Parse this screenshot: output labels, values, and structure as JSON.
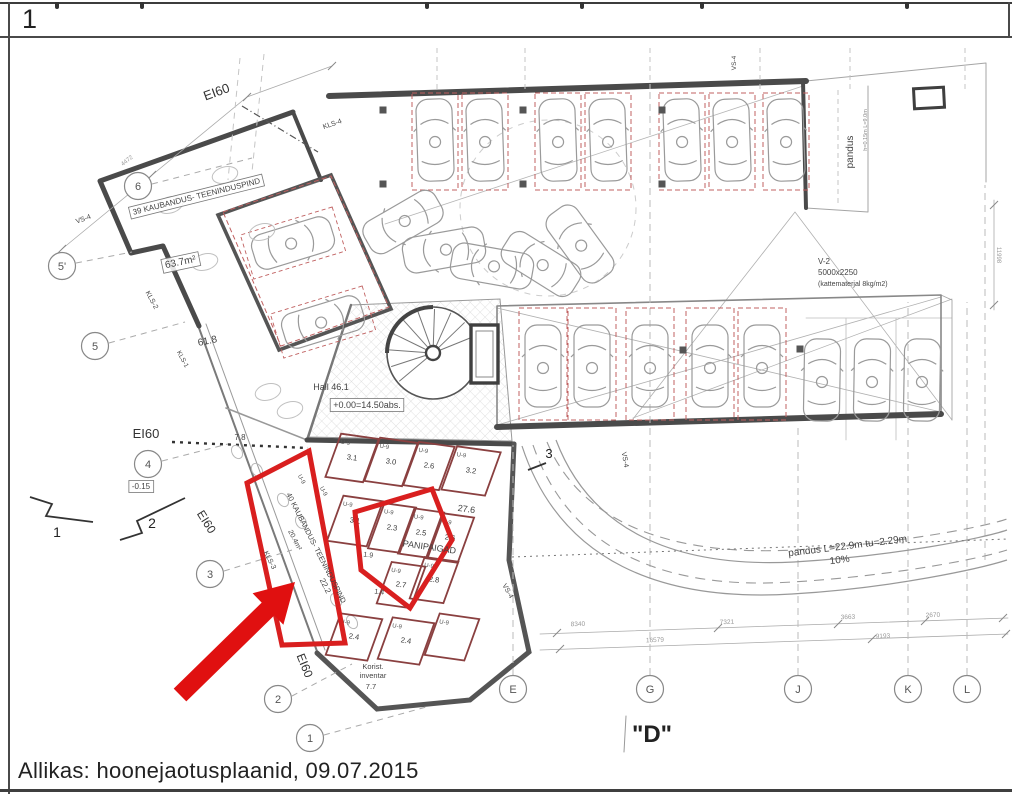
{
  "page": {
    "sheet_number": "1",
    "caption": "Allikas: hoonejaotusplaanid, 09.07.2015",
    "detail_label": "\"D\""
  },
  "colors": {
    "highlight_red": "#d91f1f",
    "arrow_red": "#e01010",
    "wall_dark": "#4a4a4a",
    "drawing_gray": "#9a9a9a",
    "parking_stall_red": "#c06060",
    "storage_wall_red": "#8a4040",
    "text_dark": "#333333"
  },
  "plan": {
    "grid_left": [
      {
        "label": "6",
        "x": 138,
        "y": 186
      },
      {
        "label": "5'",
        "x": 62,
        "y": 266
      },
      {
        "label": "5",
        "x": 95,
        "y": 346
      },
      {
        "label": "4",
        "x": 148,
        "y": 464
      },
      {
        "label": "3",
        "x": 210,
        "y": 574
      },
      {
        "label": "2",
        "x": 278,
        "y": 699
      },
      {
        "label": "1",
        "x": 310,
        "y": 738
      }
    ],
    "grid_bottom": [
      {
        "label": "E",
        "x": 513,
        "y": 689
      },
      {
        "label": "G",
        "x": 650,
        "y": 689
      },
      {
        "label": "J",
        "x": 798,
        "y": 689
      },
      {
        "label": "K",
        "x": 908,
        "y": 689
      },
      {
        "label": "L",
        "x": 967,
        "y": 689
      }
    ],
    "labels": [
      {
        "t": "EI60",
        "x": 218,
        "y": 96,
        "r": -20,
        "s": 13,
        "c": "#333"
      },
      {
        "t": "KLS-4",
        "x": 333,
        "y": 126,
        "r": -19,
        "s": 7
      },
      {
        "t": "VS-4",
        "x": 84,
        "y": 221,
        "r": -20,
        "s": 7
      },
      {
        "t": "4472",
        "x": 128,
        "y": 162,
        "r": -38,
        "s": 6,
        "c": "#999"
      },
      {
        "t": "39 KAUBANDUS- TEENINDUSPIND",
        "x": 197,
        "y": 199,
        "r": -14,
        "s": 8,
        "b": 1
      },
      {
        "t": "63.7m²",
        "x": 181,
        "y": 265,
        "r": -12,
        "s": 10,
        "b": 1
      },
      {
        "t": "KLS-2",
        "x": 150,
        "y": 301,
        "r": 62,
        "s": 7
      },
      {
        "t": "61.8",
        "x": 208,
        "y": 344,
        "r": -12,
        "s": 10
      },
      {
        "t": "KLS-1",
        "x": 181,
        "y": 360,
        "r": 62,
        "s": 6.5
      },
      {
        "t": "Hall   46.1",
        "x": 331,
        "y": 390,
        "r": 0,
        "s": 9
      },
      {
        "t": "+0.00=14.50abs.",
        "x": 367,
        "y": 408,
        "r": 0,
        "s": 9,
        "b": 1
      },
      {
        "t": "7.8",
        "x": 240,
        "y": 440,
        "r": 0,
        "s": 8
      },
      {
        "t": "EI60",
        "x": 146,
        "y": 438,
        "r": 0,
        "s": 13,
        "c": "#333"
      },
      {
        "t": "-0.15",
        "x": 141,
        "y": 489,
        "r": 0,
        "s": 8,
        "b": 1
      },
      {
        "t": "EI60",
        "x": 203,
        "y": 524,
        "r": 58,
        "s": 12,
        "c": "#333"
      },
      {
        "t": "U-9",
        "x": 300,
        "y": 480,
        "r": 62,
        "s": 6
      },
      {
        "t": "U-9",
        "x": 322,
        "y": 492,
        "r": 62,
        "s": 6
      },
      {
        "t": "40 KAUBANDUS- TEENINDUSPIND",
        "x": 314,
        "y": 549,
        "r": 63,
        "s": 7.5
      },
      {
        "t": "20.4m²",
        "x": 293,
        "y": 541,
        "r": 63,
        "s": 7
      },
      {
        "t": "KLS-3",
        "x": 268,
        "y": 561,
        "r": 63,
        "s": 7
      },
      {
        "t": "22.2",
        "x": 323,
        "y": 587,
        "r": 63,
        "s": 8
      },
      {
        "t": "EI60",
        "x": 301,
        "y": 667,
        "r": 68,
        "s": 12,
        "c": "#333"
      },
      {
        "t": "PANIPAIGAD",
        "x": 429,
        "y": 550,
        "r": 8,
        "s": 9
      },
      {
        "t": "27.6",
        "x": 466,
        "y": 512,
        "r": 8,
        "s": 9
      },
      {
        "t": "1.9",
        "x": 368,
        "y": 557,
        "r": 8,
        "s": 7
      },
      {
        "t": "1.4",
        "x": 379,
        "y": 594,
        "r": 8,
        "s": 7
      },
      {
        "t": "Korist.",
        "x": 373,
        "y": 669,
        "r": 0,
        "s": 7.5
      },
      {
        "t": "inventar",
        "x": 373,
        "y": 678,
        "r": 0,
        "s": 7.5
      },
      {
        "t": "7.7",
        "x": 371,
        "y": 689,
        "r": 0,
        "s": 7.5
      },
      {
        "t": "VS-4",
        "x": 506,
        "y": 592,
        "r": 60,
        "s": 7
      },
      {
        "t": "VS-4",
        "x": 623,
        "y": 460,
        "r": 80,
        "s": 7
      },
      {
        "t": "VS-4",
        "x": 736,
        "y": 63,
        "r": -90,
        "s": 6.5
      },
      {
        "t": "V-2",
        "x": 818,
        "y": 264,
        "r": 0,
        "s": 8,
        "a": "start"
      },
      {
        "t": "5000x2250",
        "x": 818,
        "y": 275,
        "r": 0,
        "s": 8,
        "a": "start"
      },
      {
        "t": "(kattematerjal 8kg/m2)",
        "x": 818,
        "y": 286,
        "r": 0,
        "s": 7,
        "a": "start"
      },
      {
        "t": "pandus",
        "x": 853,
        "y": 152,
        "r": -90,
        "s": 10
      },
      {
        "t": "h=0.15m L=9.0m",
        "x": 867,
        "y": 130,
        "r": -90,
        "s": 5.5,
        "c": "#888"
      },
      {
        "t": "pandus L=22.9m tu=2.29m",
        "x": 848,
        "y": 549,
        "r": -7,
        "s": 10
      },
      {
        "t": "10%",
        "x": 840,
        "y": 563,
        "r": -7,
        "s": 10
      },
      {
        "t": "8340",
        "x": 578,
        "y": 626,
        "r": -2,
        "s": 6.5,
        "c": "#999"
      },
      {
        "t": "7321",
        "x": 727,
        "y": 624,
        "r": -2,
        "s": 6.5,
        "c": "#999"
      },
      {
        "t": "3663",
        "x": 848,
        "y": 619,
        "r": -2,
        "s": 6.5,
        "c": "#999"
      },
      {
        "t": "2670",
        "x": 933,
        "y": 617,
        "r": -2,
        "s": 6.5,
        "c": "#999"
      },
      {
        "t": "16579",
        "x": 655,
        "y": 642,
        "r": -2,
        "s": 6.5,
        "c": "#999"
      },
      {
        "t": "9193",
        "x": 883,
        "y": 638,
        "r": -2,
        "s": 6.5,
        "c": "#999"
      },
      {
        "t": "11998",
        "x": 997,
        "y": 255,
        "r": 90,
        "s": 6,
        "c": "#999"
      },
      {
        "t": "1",
        "x": 57,
        "y": 537,
        "r": 0,
        "s": 14,
        "c": "#222"
      },
      {
        "t": "2",
        "x": 152,
        "y": 528,
        "r": 0,
        "s": 14,
        "c": "#222"
      },
      {
        "t": "3",
        "x": 549,
        "y": 458,
        "r": 0,
        "s": 13,
        "c": "#222"
      },
      {
        "t": "\"D\"",
        "x": 652,
        "y": 742,
        "r": 0,
        "s": 24,
        "c": "#222",
        "w": 700
      }
    ],
    "storage_rooms": [
      {
        "n": "3.1",
        "x": 352,
        "y": 458,
        "w": 38,
        "h": 46
      },
      {
        "n": "3.0",
        "x": 391,
        "y": 462,
        "w": 38,
        "h": 46
      },
      {
        "n": "2.6",
        "x": 429,
        "y": 466,
        "w": 36,
        "h": 46
      },
      {
        "n": "3.2",
        "x": 471,
        "y": 471,
        "w": 44,
        "h": 46
      },
      {
        "n": "3.1",
        "x": 355,
        "y": 521,
        "w": 40,
        "h": 48
      },
      {
        "n": "2.3",
        "x": 392,
        "y": 528,
        "w": 32,
        "h": 48
      },
      {
        "n": "2.5",
        "x": 421,
        "y": 533,
        "w": 30,
        "h": 48
      },
      {
        "n": "2.6",
        "x": 450,
        "y": 538,
        "w": 32,
        "h": 48
      },
      {
        "n": "2.7",
        "x": 401,
        "y": 585,
        "w": 34,
        "h": 44
      },
      {
        "n": "2.8",
        "x": 434,
        "y": 580,
        "w": 34,
        "h": 44
      },
      {
        "n": "2.4",
        "x": 354,
        "y": 637,
        "w": 42,
        "h": 44
      },
      {
        "n": "2.4",
        "x": 406,
        "y": 641,
        "w": 42,
        "h": 44
      },
      {
        "n": "",
        "x": 452,
        "y": 637,
        "w": 40,
        "h": 44
      }
    ],
    "storage_door_label": "U-9",
    "parking": {
      "top_row_y": 140,
      "top_row_x": [
        435,
        485,
        558,
        608,
        682,
        732,
        786
      ],
      "middle_row_y": 366,
      "middle_row_x": [
        543,
        592,
        650,
        710,
        762
      ],
      "right_row_y": 380,
      "right_row_x": [
        822,
        872,
        922
      ],
      "garage_tilted": [
        {
          "x": 293,
          "y": 243,
          "r": 73
        },
        {
          "x": 323,
          "y": 322,
          "r": 73
        }
      ],
      "sweep": [
        {
          "x": 403,
          "y": 222,
          "r": -120
        },
        {
          "x": 444,
          "y": 250,
          "r": -100
        },
        {
          "x": 492,
          "y": 266,
          "r": -80
        },
        {
          "x": 541,
          "y": 264,
          "r": -58
        },
        {
          "x": 580,
          "y": 244,
          "r": -36
        }
      ]
    }
  }
}
